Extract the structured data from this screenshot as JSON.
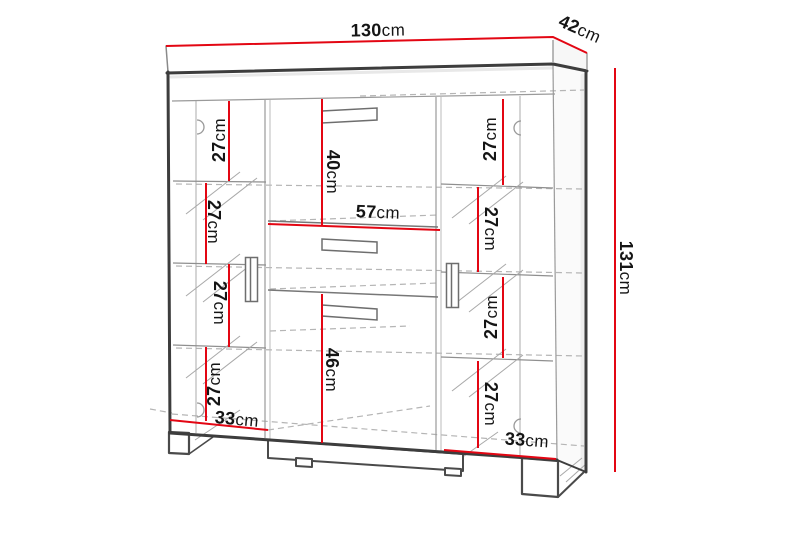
{
  "diagram": {
    "kind": "furniture-dimension-drawing",
    "unit": "cm",
    "colors": {
      "dimension_line": "#e30613",
      "outline": "#3d3d3d",
      "interior_line": "#9a9a9a",
      "dashed_line": "#b5b5b5",
      "text": "#151515",
      "background": "#ffffff"
    }
  },
  "labels": {
    "width": {
      "value": "130",
      "unit": "cm"
    },
    "depth": {
      "value": "42",
      "unit": "cm"
    },
    "height": {
      "value": "131",
      "unit": "cm"
    },
    "upper_middle_height": {
      "value": "40",
      "unit": "cm"
    },
    "middle_width": {
      "value": "57",
      "unit": "cm"
    },
    "lower_middle_height": {
      "value": "46",
      "unit": "cm"
    },
    "left_section_width": {
      "value": "33",
      "unit": "cm"
    },
    "right_section_width": {
      "value": "33",
      "unit": "cm"
    },
    "left_shelves": [
      {
        "value": "27",
        "unit": "cm"
      },
      {
        "value": "27",
        "unit": "cm"
      },
      {
        "value": "27",
        "unit": "cm"
      },
      {
        "value": "27",
        "unit": "cm"
      }
    ],
    "right_shelves": [
      {
        "value": "27",
        "unit": "cm"
      },
      {
        "value": "27",
        "unit": "cm"
      },
      {
        "value": "27",
        "unit": "cm"
      },
      {
        "value": "27",
        "unit": "cm"
      }
    ]
  }
}
